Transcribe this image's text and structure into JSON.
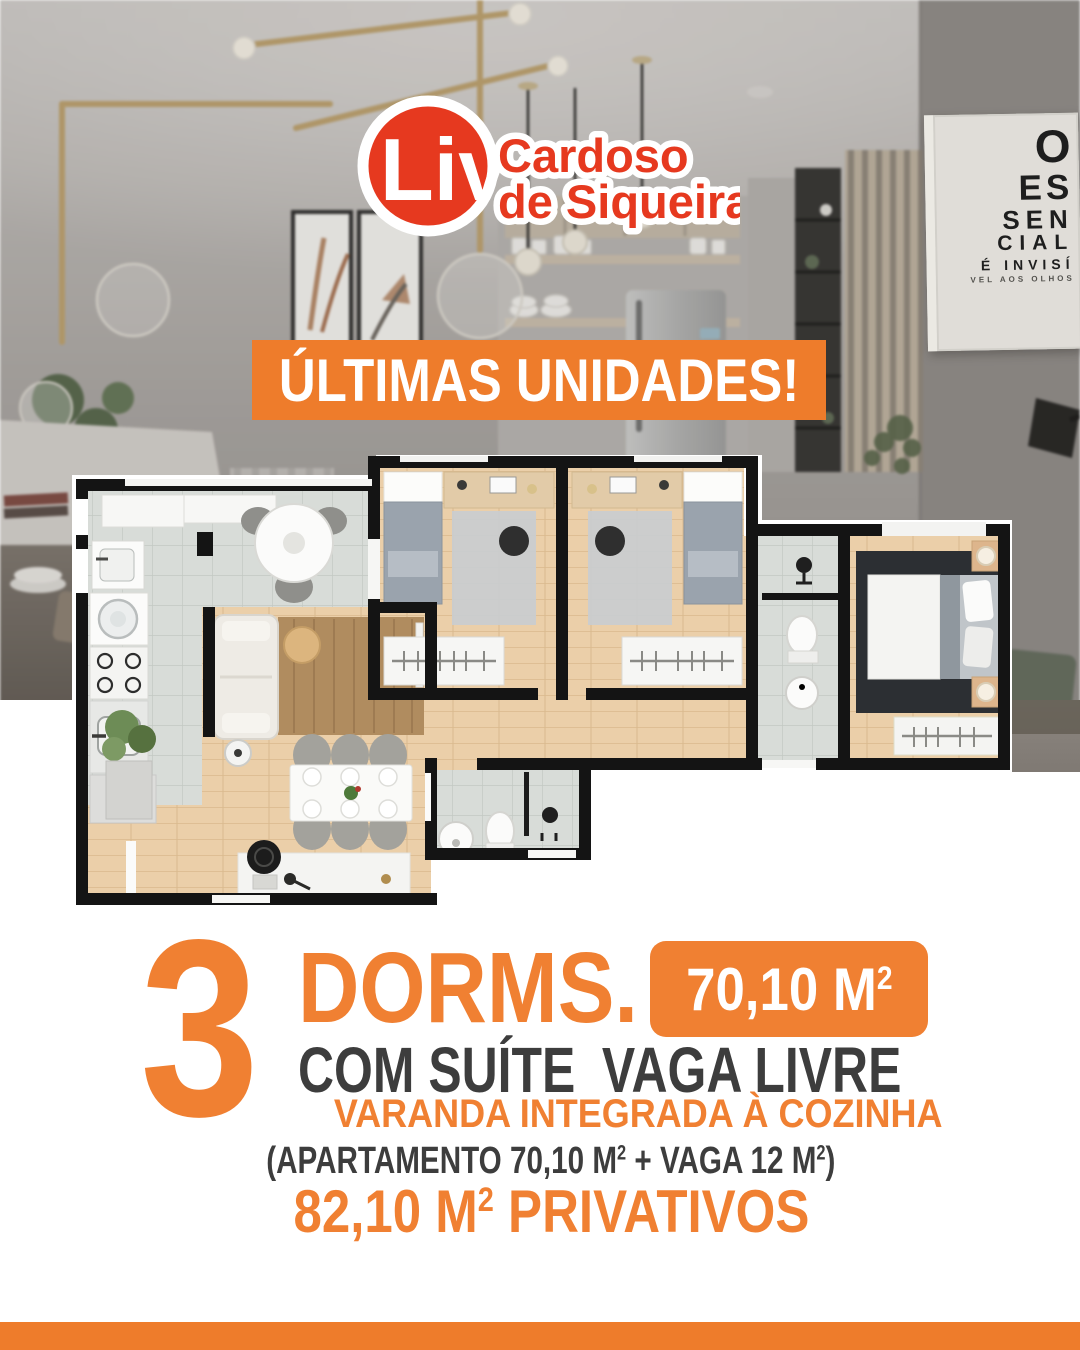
{
  "logo": {
    "brand": "Liv",
    "name_line1": "Cardoso",
    "name_line2": "de Siqueira"
  },
  "banner": {
    "text": "ÚLTIMAS UNIDADES!"
  },
  "poster": {
    "line1": "O",
    "line2": "ES",
    "line3": "SEN",
    "line4": "CIAL",
    "line5": "É INVISÍ",
    "line6": "VEL AOS OLHOS"
  },
  "details": {
    "dorms_count": "3",
    "dorms_label": "DORMS.",
    "area_badge": {
      "value": "70,10 M",
      "sup": "2"
    },
    "suite_label": "COM SUÍTE",
    "vaga_label": "VAGA LIVRE",
    "varanda_label": "VARANDA INTEGRADA À COZINHA",
    "breakdown": {
      "part1": "(APARTAMENTO 70,10 M",
      "sup1": "2",
      "part2": " + VAGA 12 M",
      "sup2": "2",
      "part3": ")"
    },
    "total": {
      "part1": "82,10 M",
      "sup": "2",
      "part2": " PRIVATIVOS"
    }
  },
  "colors": {
    "accent_orange": "#EE7C2B",
    "accent_orange_text": "#F08032",
    "logo_red": "#E6391F",
    "dark_text": "#3D3D3D"
  }
}
